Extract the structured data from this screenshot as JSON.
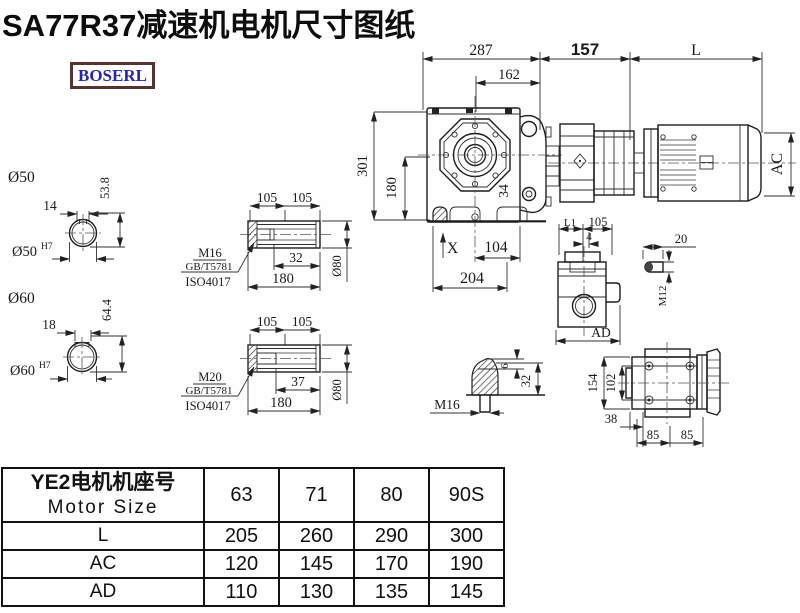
{
  "title": "SA77R37减速机电机尺寸图纸",
  "logo": {
    "text": "BOSERL"
  },
  "colors": {
    "line": "#1d1d1d",
    "logo_text": "#2424bb",
    "logo_border": "#553333",
    "background": "#ffffff"
  },
  "dims": {
    "w287": "287",
    "w162": "162",
    "w157": "157",
    "L": "L",
    "h301": "301",
    "h180": "180",
    "n34": "34",
    "X": "X",
    "n104": "104",
    "n204": "204",
    "AC": "AC",
    "L1": "L1",
    "n105sv": "105",
    "n4": "4",
    "AD": "AD",
    "n20": "20",
    "M12": "M12",
    "M16plug": "M16",
    "n6": "6",
    "n32plug": "32",
    "n154": "154",
    "n102": "102",
    "n38": "38",
    "n85a": "85",
    "n85b": "85",
    "dia50": "Ø50",
    "k14": "14",
    "h538": "53.8",
    "dia50b": "Ø50",
    "h7a": "H7",
    "dia60": "Ø60",
    "k18": "18",
    "h644": "64.4",
    "dia60b": "Ø60",
    "h7b": "H7",
    "s1_105a": "105",
    "s1_105b": "105",
    "s1_32": "32",
    "s1_180": "180",
    "s1_d80": "Ø80",
    "s1_m": "M16",
    "s1_gb": "GB/T5781",
    "s1_iso": "ISO4017",
    "s2_105a": "105",
    "s2_105b": "105",
    "s2_37": "37",
    "s2_180": "180",
    "s2_d80": "Ø80",
    "s2_m": "M20",
    "s2_gb": "GB/T5781",
    "s2_iso": "ISO4017"
  },
  "table": {
    "header_zh": "YE2电机机座号",
    "header_en": "Motor Size",
    "columns": [
      "63",
      "71",
      "80",
      "90S"
    ],
    "rows": [
      {
        "label": "L",
        "values": [
          "205",
          "260",
          "290",
          "300"
        ]
      },
      {
        "label": "AC",
        "values": [
          "120",
          "145",
          "170",
          "190"
        ]
      },
      {
        "label": "AD",
        "values": [
          "110",
          "130",
          "135",
          "145"
        ]
      }
    ]
  }
}
